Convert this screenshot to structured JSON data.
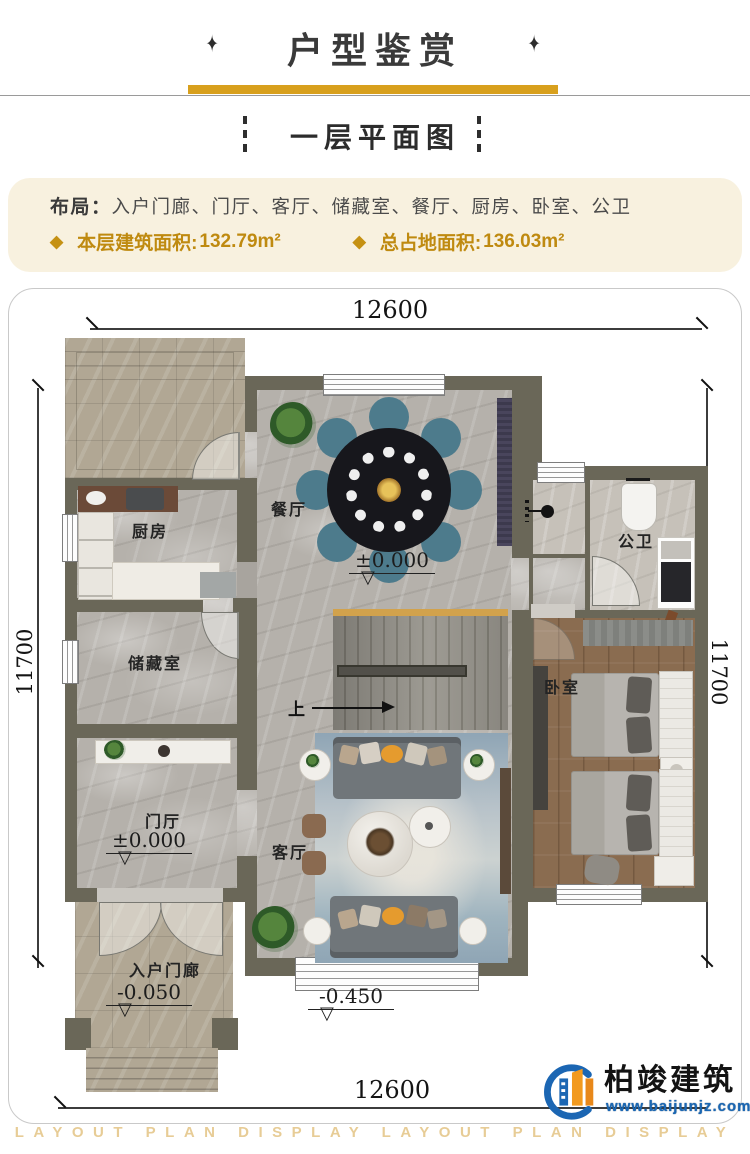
{
  "header": {
    "title": "户型鉴赏",
    "ornament": "✦"
  },
  "subtitle": {
    "text": "一层平面图"
  },
  "info": {
    "layout_label": "布局：",
    "layout_value": "入户门廊、门厅、客厅、储藏室、餐厅、厨房、卧室、公卫",
    "bullet": "◆",
    "stats": [
      {
        "label": "本层建筑面积:",
        "value": "132.79m²"
      },
      {
        "label": "总占地面积:",
        "value": "136.03m²"
      }
    ]
  },
  "plan": {
    "dims": {
      "top": "12600",
      "bottom": "12600",
      "left": "11700",
      "right": "11700"
    },
    "rooms": {
      "kitchen": "厨房",
      "dining": "餐厅",
      "bath": "公卫",
      "storage": "储藏室",
      "bedroom": "卧室",
      "foyer": "门厅",
      "living": "客厅",
      "porch": "入户门廊"
    },
    "stair_up": "上",
    "elevations": {
      "dining": "±0.000",
      "foyer": "±0.000",
      "porch": "-0.050",
      "street": "-0.450"
    },
    "level_triangle": "▽"
  },
  "logo": {
    "name": "柏竣建筑",
    "url": "www.baijunjz.com"
  },
  "watermark": "LAYOUT PLAN DISPLAY LAYOUT PLAN DISPLAY",
  "colors": {
    "accent_gold": "#d8a01d",
    "text_gold": "#bf8a10",
    "wall": "#6a6758",
    "infobox_bg": "#f8f1df"
  }
}
